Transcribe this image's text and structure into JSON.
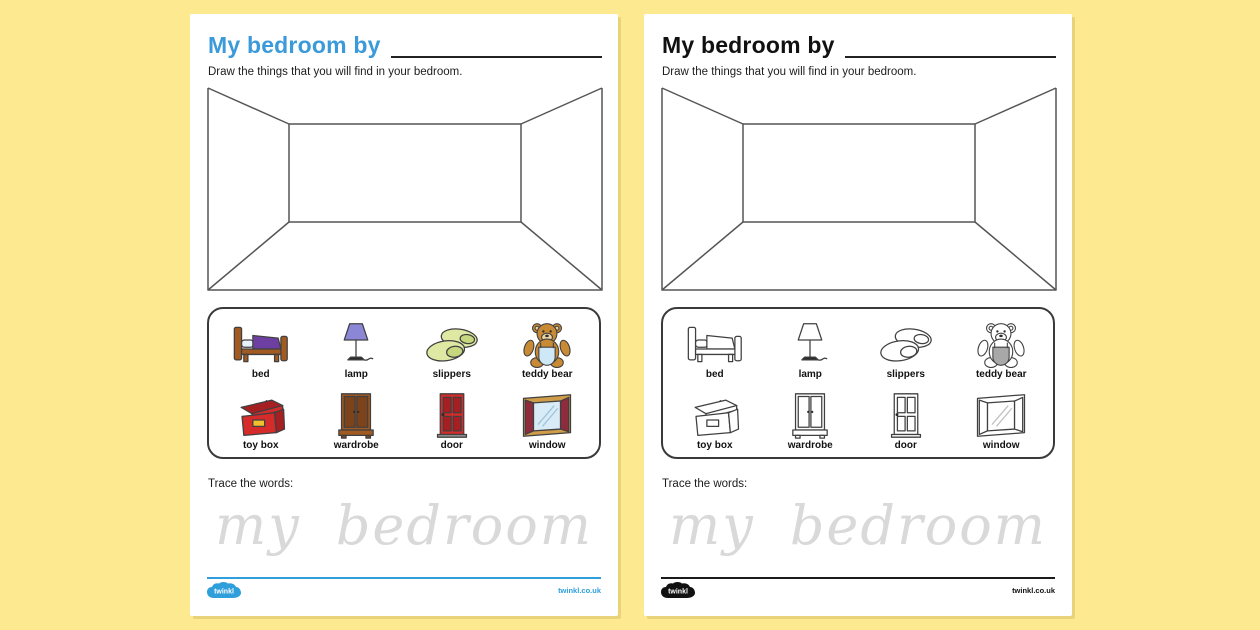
{
  "colors": {
    "page_bg": "#fdea90",
    "title_blue": "#3b9ad9",
    "footer_blue": "#2f9fdb",
    "trace_grey": "#d9d9d9"
  },
  "worksheet": {
    "title": "My bedroom by",
    "instruction": "Draw the things that you will find in your bedroom.",
    "trace_label": "Trace the words:",
    "trace_words": "my bedroom",
    "brand": "twinkl",
    "brand_url": "twinkl.co.uk"
  },
  "pages": [
    {
      "variant": "colour"
    },
    {
      "variant": "black-and-white"
    }
  ],
  "items": [
    {
      "label": "bed",
      "icon": "bed-icon"
    },
    {
      "label": "lamp",
      "icon": "lamp-icon"
    },
    {
      "label": "slippers",
      "icon": "slippers-icon"
    },
    {
      "label": "teddy bear",
      "icon": "teddy-bear-icon"
    },
    {
      "label": "toy box",
      "icon": "toy-box-icon"
    },
    {
      "label": "wardrobe",
      "icon": "wardrobe-icon"
    },
    {
      "label": "door",
      "icon": "door-icon"
    },
    {
      "label": "window",
      "icon": "window-icon"
    }
  ]
}
